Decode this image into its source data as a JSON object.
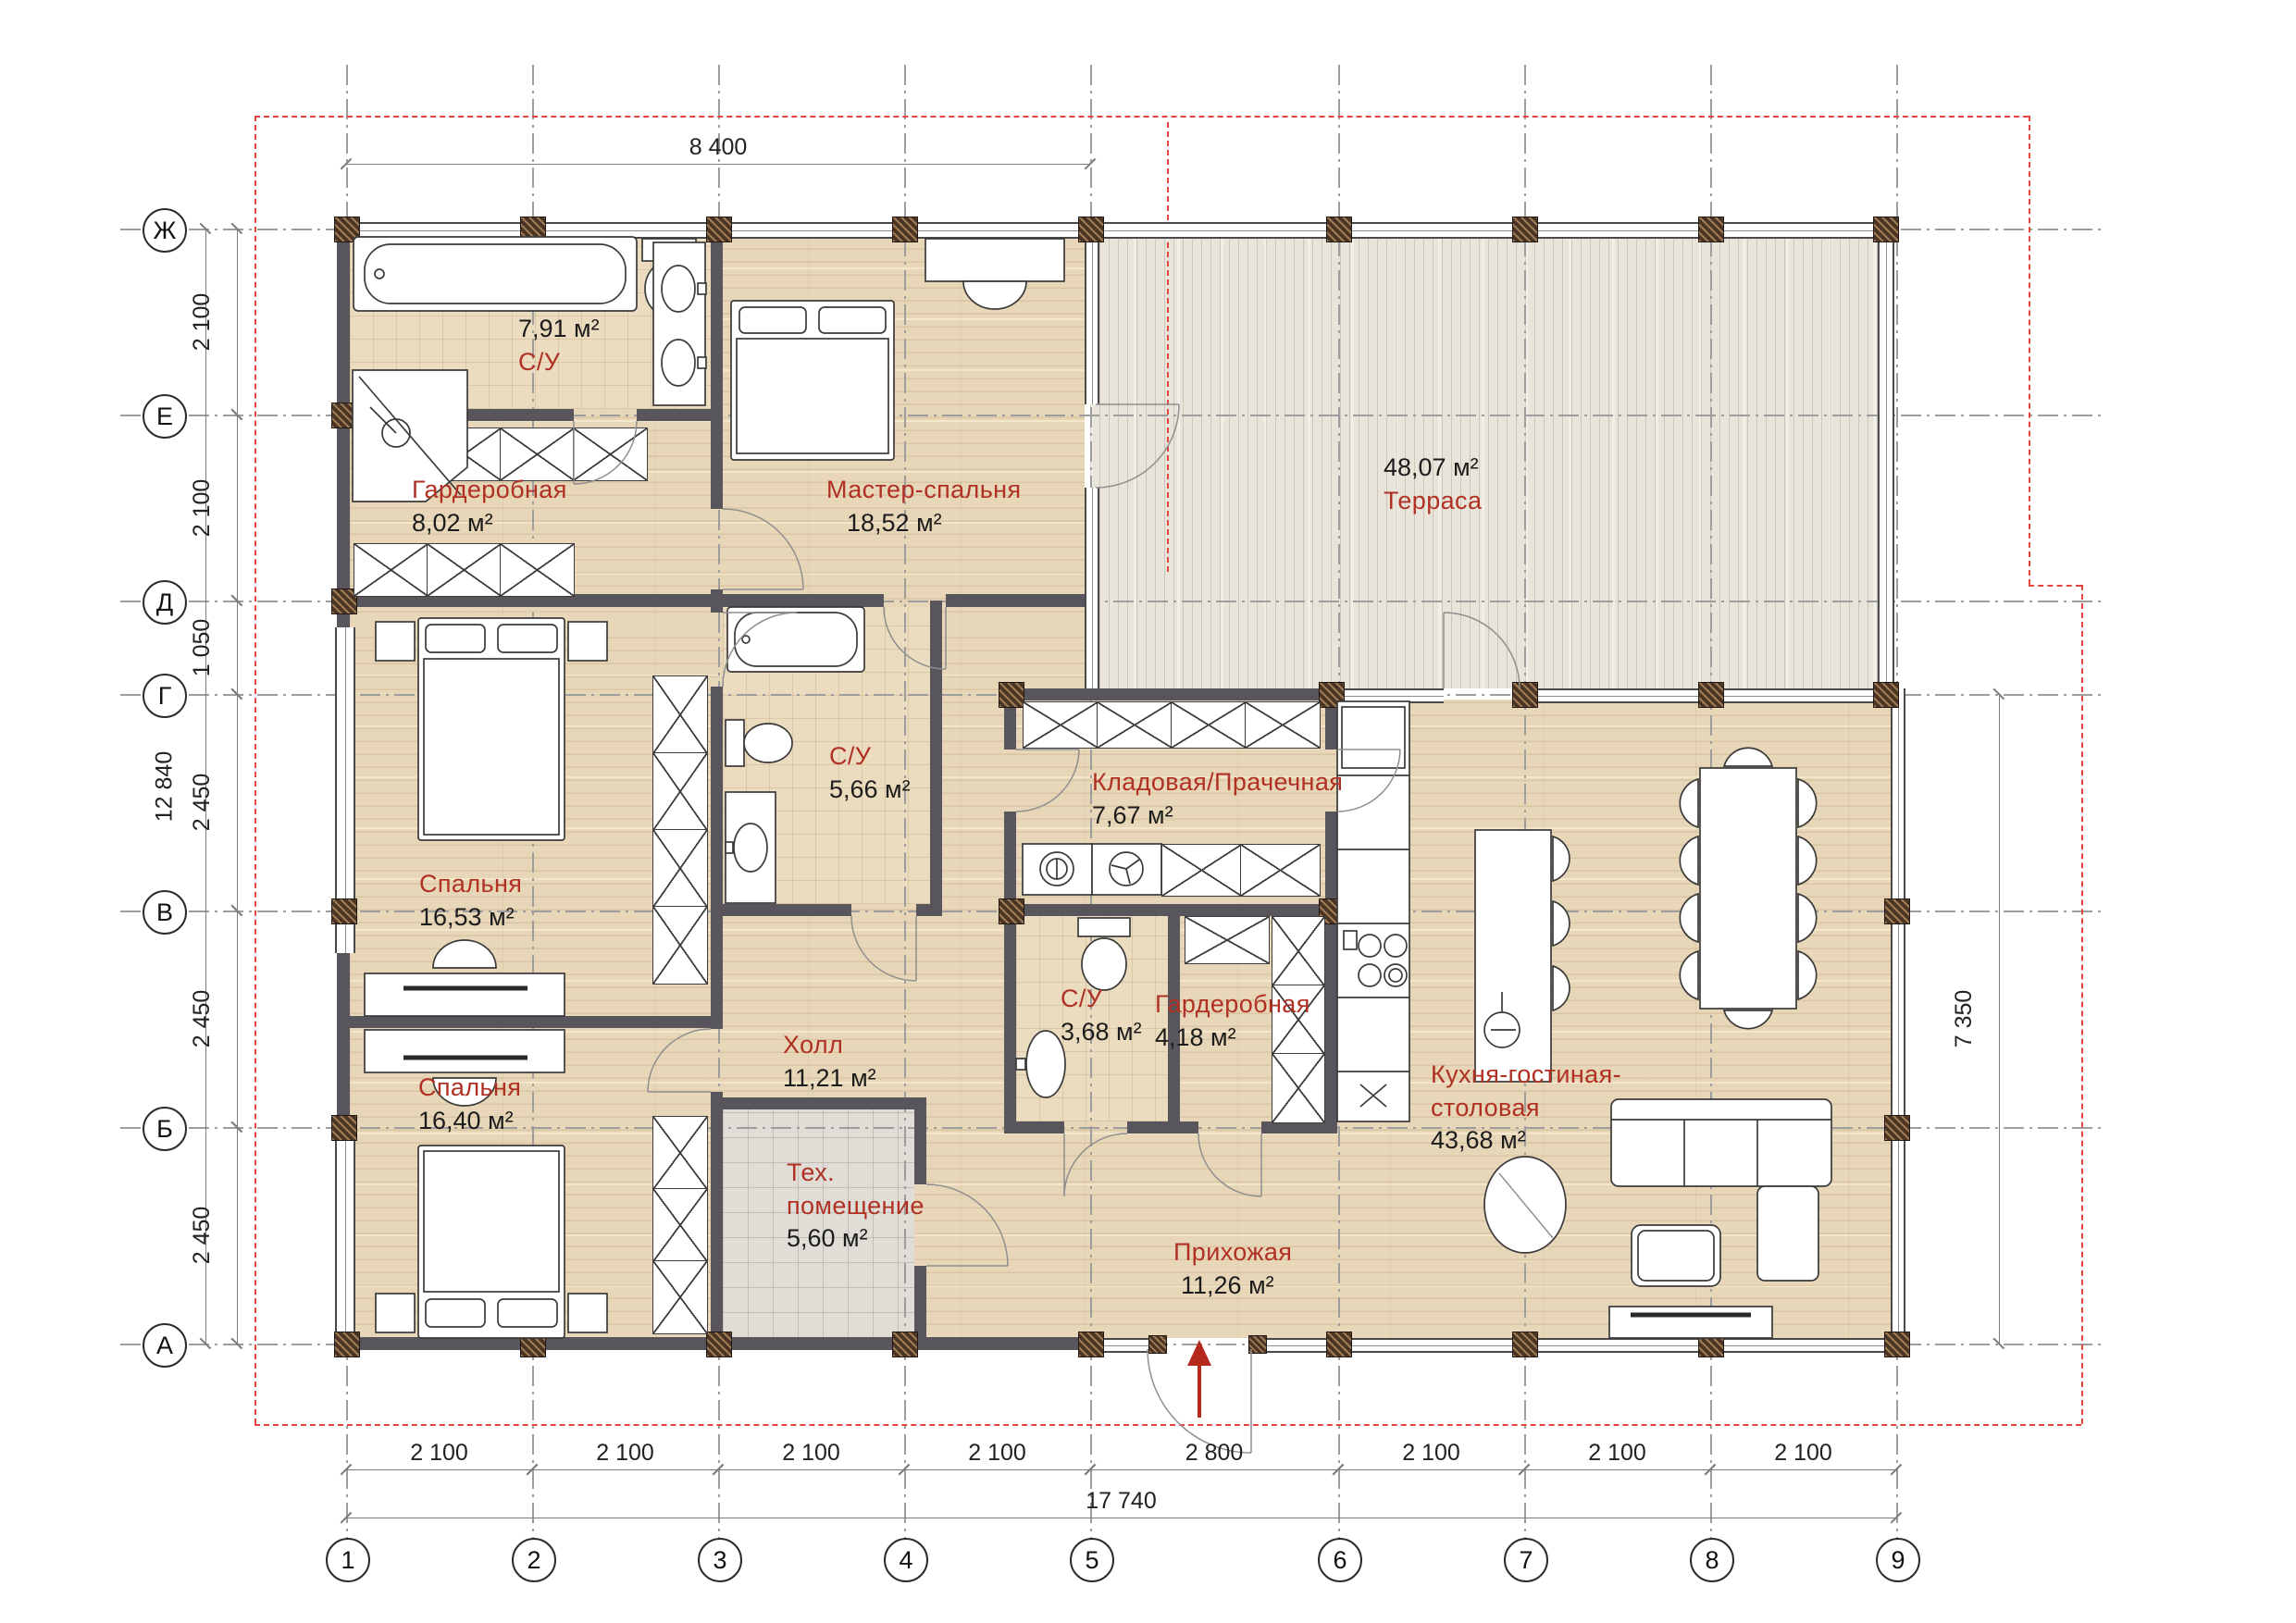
{
  "axes": {
    "cols": [
      "1",
      "2",
      "3",
      "4",
      "5",
      "6",
      "7",
      "8",
      "9"
    ],
    "rows": [
      "Ж",
      "Е",
      "Д",
      "Г",
      "В",
      "Б",
      "А"
    ]
  },
  "dimensions": {
    "top": "8 400",
    "left_total": "12 840",
    "left": [
      "2 100",
      "2 100",
      "1 050",
      "2 450",
      "2 450",
      "2 450"
    ],
    "right": "7 350",
    "bottom": [
      "2 100",
      "2 100",
      "2 100",
      "2 100",
      "2 800",
      "2 100",
      "2 100",
      "2 100"
    ],
    "bottom_total": "17 740"
  },
  "rooms": [
    {
      "name": "С/У",
      "area": "7,91 м²"
    },
    {
      "name": "Гардеробная",
      "area": "8,02 м²"
    },
    {
      "name": "Мастер-спальня",
      "area": "18,52 м²"
    },
    {
      "name": "Терраса",
      "area": "48,07 м²"
    },
    {
      "name": "Спальня",
      "area": "16,53 м²"
    },
    {
      "name": "С/У",
      "area": "5,66 м²"
    },
    {
      "name": "Кладовая/Прачечная",
      "area": "7,67 м²"
    },
    {
      "name": "Холл",
      "area": "11,21 м²"
    },
    {
      "name": "С/У",
      "area": "3,68 м²"
    },
    {
      "name": "Гардеробная",
      "area": "4,18 м²"
    },
    {
      "name": "Спальня",
      "area": "16,40 м²"
    },
    {
      "name": "Тех.",
      "name2": "помещение",
      "area": "5,60 м²"
    },
    {
      "name": "Прихожая",
      "area": "11,26 м²"
    },
    {
      "name": "Кухня-гостиная-",
      "name2": "столовая",
      "area": "43,68 м²"
    }
  ],
  "colors": {
    "wall": "#58565c",
    "column": "#4a3423",
    "room_label": "#b03124",
    "boundary": "#e2453b"
  }
}
